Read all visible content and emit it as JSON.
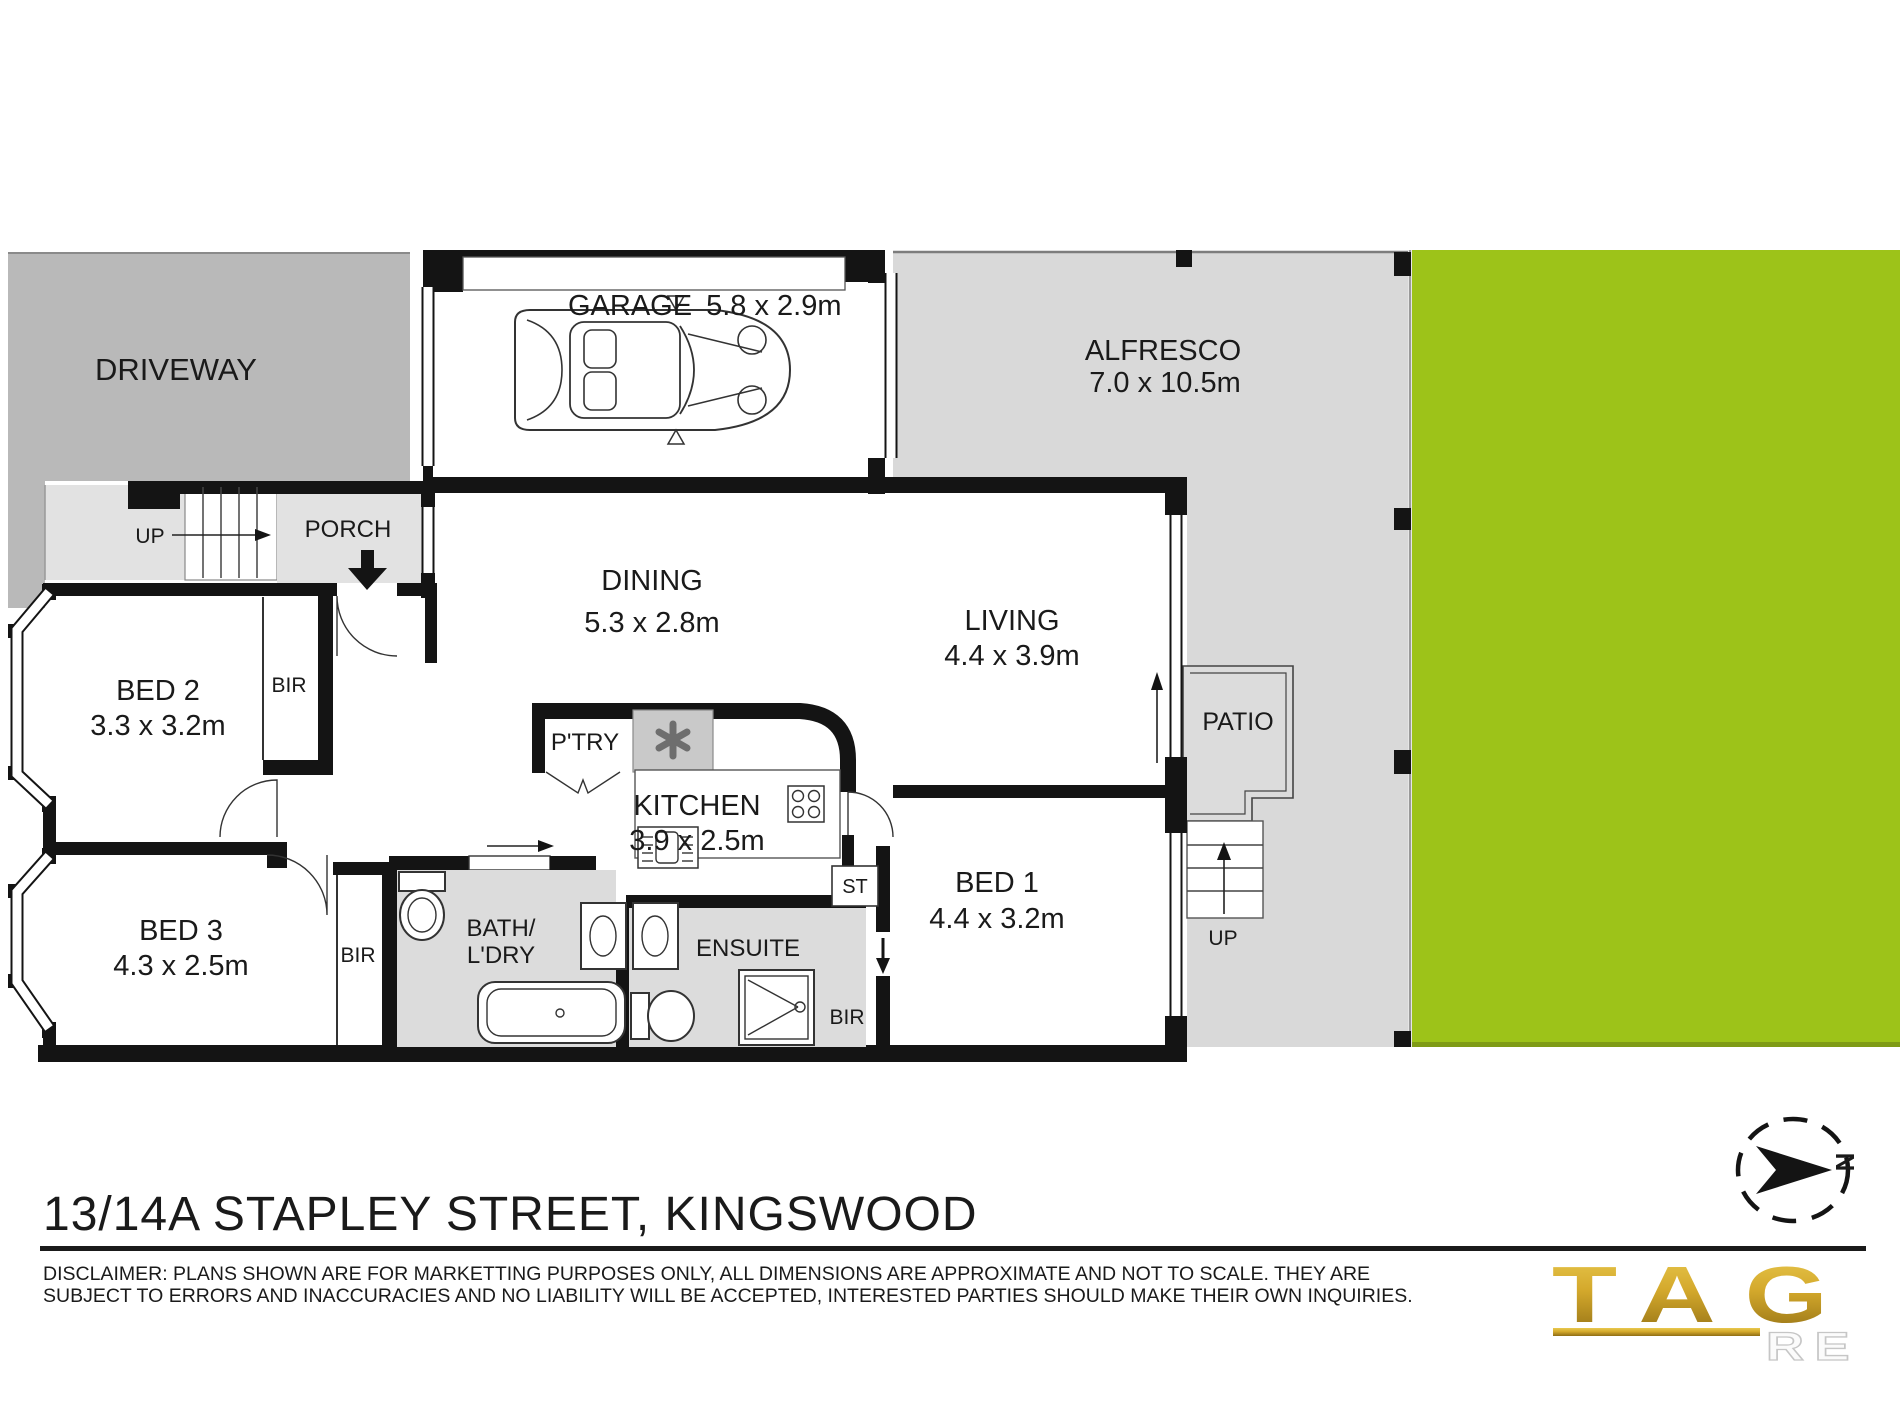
{
  "plan": {
    "site": {
      "driveway": "DRIVEWAY",
      "alfresco_name": "ALFRESCO",
      "alfresco_dims": "7.0 x 10.5m",
      "porch": "PORCH",
      "patio": "PATIO",
      "front_stairs_up": "UP",
      "rear_stairs_up": "UP"
    },
    "rooms": {
      "garage": {
        "name": "GARAGE",
        "dims": "5.8 x 2.9m"
      },
      "dining": {
        "name": "DINING",
        "dims": "5.3 x 2.8m"
      },
      "living": {
        "name": "LIVING",
        "dims": "4.4 x 3.9m"
      },
      "kitchen": {
        "name": "KITCHEN",
        "dims": "3.9 x 2.5m"
      },
      "bed1": {
        "name": "BED 1",
        "dims": "4.4 x 3.2m"
      },
      "bed2": {
        "name": "BED 2",
        "dims": "3.3 x 3.2m"
      },
      "bed3": {
        "name": "BED 3",
        "dims": "4.3 x 2.5m"
      }
    },
    "utility": {
      "pantry": "P'TRY",
      "bath_line1": "BATH/",
      "bath_line2": "L'DRY",
      "ensuite": "ENSUITE",
      "storage": "ST",
      "bir": "BIR"
    }
  },
  "footer": {
    "address": "13/14A STAPLEY STREET, KINGSWOOD",
    "disclaimer_line1": "DISCLAIMER: PLANS SHOWN ARE FOR MARKETTING PURPOSES ONLY, ALL DIMENSIONS ARE APPROXIMATE AND NOT TO SCALE. THEY ARE",
    "disclaimer_line2": "SUBJECT TO ERRORS AND INACCURACIES AND NO LIABILITY WILL BE ACCEPTED, INTERESTED PARTIES SHOULD MAKE THEIR OWN INQUIRIES."
  },
  "compass": {
    "north": "N"
  },
  "logo": {
    "brand": "TAG",
    "sub": "RE"
  },
  "colors": {
    "driveway_gray": "#b9b9b9",
    "porch_gray": "#e2e2e2",
    "alfresco_gray": "#d9d9d9",
    "wet_area_gray": "#dcdcdc",
    "grass_green": "#9dc319",
    "wall_black": "#141414",
    "logo_gold": "#cda42e"
  }
}
